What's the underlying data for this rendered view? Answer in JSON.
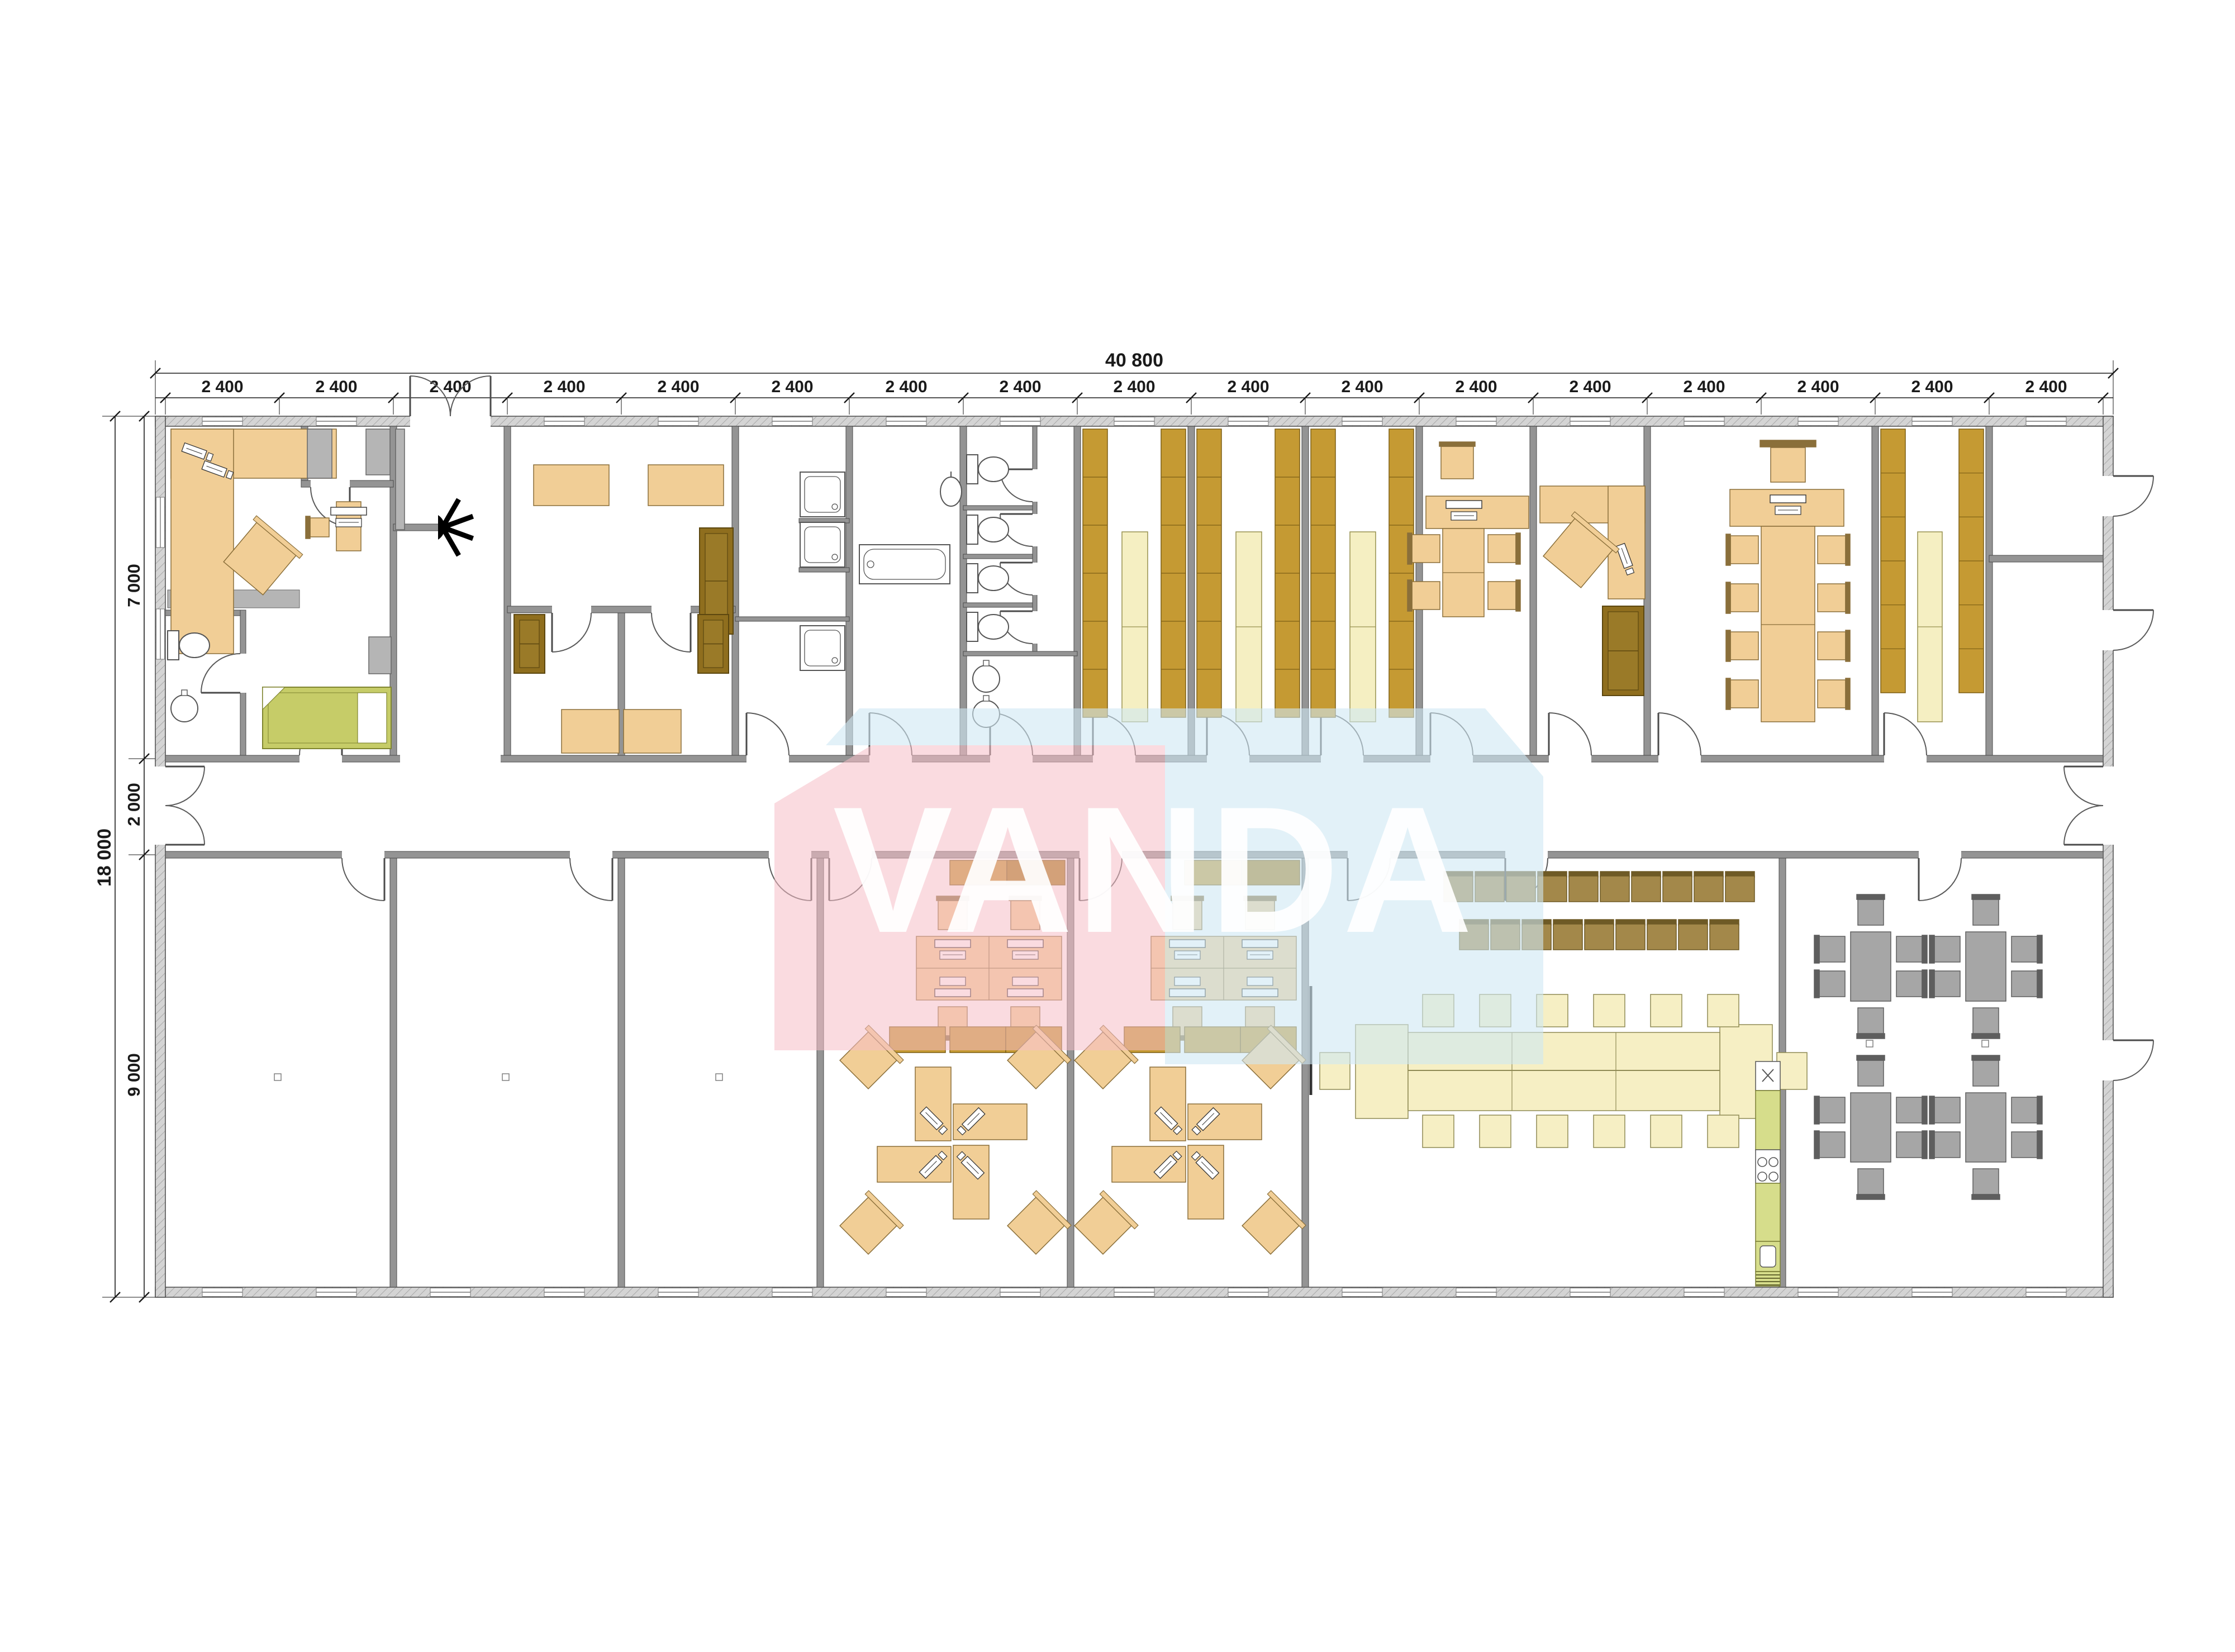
{
  "dimensions": {
    "top_total": "40 800",
    "top_segments": [
      "2 400",
      "2 400",
      "2 400",
      "2 400",
      "2 400",
      "2 400",
      "2 400",
      "2 400",
      "2 400",
      "2 400",
      "2 400",
      "2 400",
      "2 400",
      "2 400",
      "2 400",
      "2 400",
      "2 400"
    ],
    "left_total": "18 000",
    "left_segments": [
      "7 000",
      "2 000",
      "9 000"
    ]
  },
  "watermark": {
    "text": "VANDA",
    "pink": "#f6bdc7",
    "light_blue": "#cfe7f4",
    "text_color": "#ffffff"
  },
  "colors": {
    "outer_wall": "#d4d4d4",
    "outer_wall_hatch": "#a8a8a8",
    "wall": "#949494",
    "wall_line": "#4a4a4a",
    "desk_tan": "#f1ce96",
    "desk_tan_line": "#8a6f3a",
    "shelf_gold": "#c59a33",
    "shelf_gold_dark": "#a87e1c",
    "shelf_gold_line": "#7d5f14",
    "shelf_pale": "#f5efc2",
    "shelf_pale_line": "#97914f",
    "sofa_brown": "#8f6e1e",
    "sofa_brown_line": "#5c470f",
    "chair_olive": "#a3884a",
    "chair_olive_line": "#6e5a26",
    "bed_green": "#c6cc68",
    "bed_green_line": "#7f8530",
    "kitchen_green": "#d6dd8b",
    "table_cream": "#f6efc4",
    "table_cream_line": "#8f8a55",
    "gray_furniture": "#a6a6a6",
    "gray_furniture_line": "#5e5e5e",
    "fixture_white": "#ffffff",
    "fixture_line": "#555555",
    "dim_text": "#1a1a1a"
  }
}
